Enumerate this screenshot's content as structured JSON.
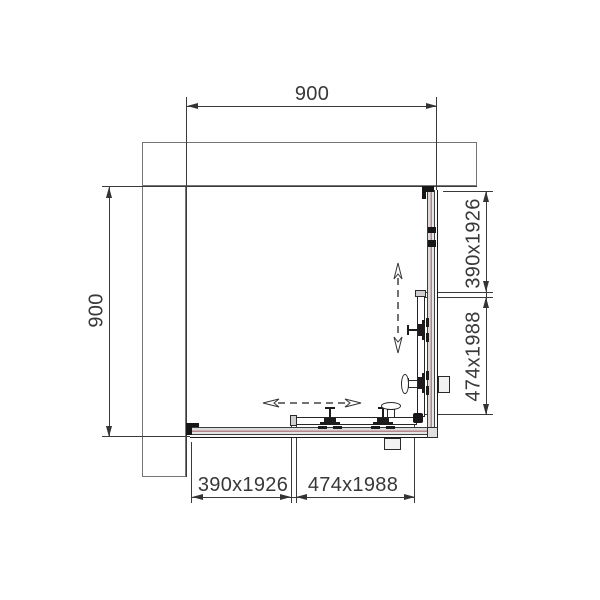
{
  "dims": {
    "top": "900",
    "left": "900",
    "right_upper": "390x1926",
    "right_lower": "474x1988",
    "bottom_left": "390x1926",
    "bottom_right": "474x1988"
  },
  "colors": {
    "line": "#3a3a3a",
    "wall_outline": "#757575",
    "glass_accent": "#b5878b"
  }
}
